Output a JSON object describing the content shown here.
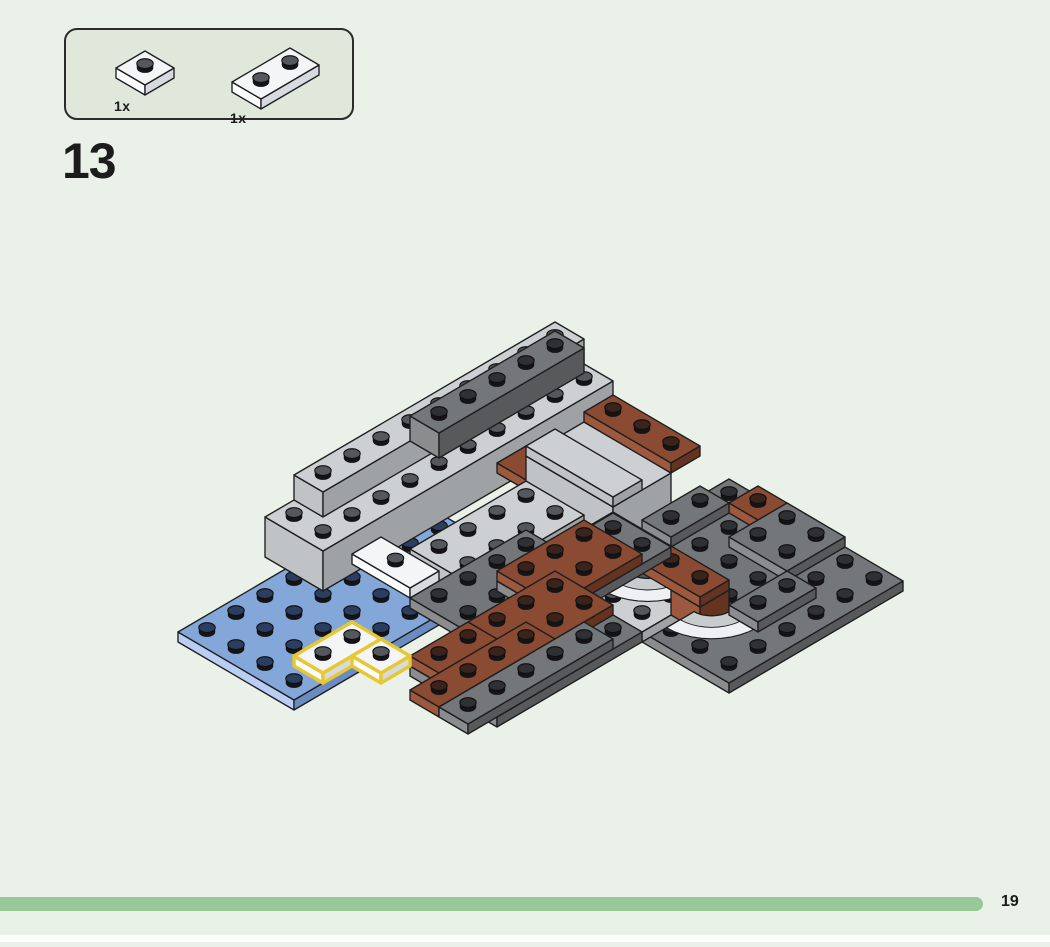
{
  "page": {
    "background": "#eaf1e8",
    "step_number": "13",
    "page_number": "19",
    "progress_color": "#97c998"
  },
  "parts_box": {
    "fill": "#dfe8db",
    "border_color": "#2b2c2b",
    "parts": [
      {
        "name": "white-plate-1x1",
        "qty_label": "1x",
        "piece": {
          "t": "box",
          "c": "WH",
          "x": 0,
          "y": 0,
          "w": 1,
          "d": 1,
          "z": 0,
          "h": 1,
          "studs": true
        }
      },
      {
        "name": "white-plate-1x2",
        "qty_label": "1x",
        "piece": {
          "t": "box",
          "c": "WH",
          "x": 0,
          "y": 0,
          "w": 2,
          "d": 1,
          "z": 0,
          "h": 1,
          "studs": true
        }
      }
    ]
  },
  "build": {
    "origin": [
      178,
      642
    ],
    "stud_dx": 29,
    "stud_dy": 17,
    "z_px": 10,
    "outline": "#1e1e20",
    "highlight": "#e7c832",
    "palette": {
      "BL": {
        "top": "#84a7da",
        "sw": "#b9cef2",
        "se": "#6a8cc0",
        "stud": "#2c3e5f"
      },
      "LG": {
        "top": "#cdd0d2",
        "sw": "#c0c3c5",
        "se": "#9fa2a4",
        "stud": "#54575b"
      },
      "DG": {
        "top": "#747779",
        "sw": "#8a8c8e",
        "se": "#58595b",
        "stud": "#2f3033"
      },
      "BR": {
        "top": "#8b4a32",
        "sw": "#9d593d",
        "se": "#643420",
        "stud": "#3a231a"
      },
      "WH": {
        "top": "#f3f5f7",
        "sw": "#fcfdfe",
        "se": "#d7dbdf",
        "stud": "#54585e"
      }
    },
    "arc_colors": {
      "main": "#c9ccce",
      "band": "#eef0f1"
    },
    "pieces": [
      {
        "t": "box",
        "c": "BL",
        "x": 0,
        "y": 0,
        "w": 8,
        "d": 4,
        "z": 0,
        "h": 1,
        "studs": true
      },
      {
        "t": "box",
        "c": "LG",
        "x": 4,
        "y": -1,
        "w": 10,
        "d": 2,
        "z": 0,
        "h": 4,
        "studs": true
      },
      {
        "t": "box",
        "c": "LG",
        "x": 5,
        "y": -1,
        "w": 9,
        "d": 1,
        "z": 4,
        "h": 2.5,
        "studs": true
      },
      {
        "t": "box",
        "c": "DG",
        "x": 8,
        "y": 0,
        "w": 5,
        "d": 1,
        "z": 6.5,
        "h": 2.5,
        "studs": true
      },
      {
        "t": "box",
        "c": "BR",
        "x": 9,
        "y": 2,
        "w": 1,
        "d": 3,
        "z": 5,
        "h": 1,
        "studs": false
      },
      {
        "t": "box",
        "c": "LG",
        "x": 10,
        "y": 2,
        "w": 2,
        "d": 3,
        "z": 0,
        "h": 5,
        "studs": false
      },
      {
        "t": "box",
        "c": "LG",
        "x": 10,
        "y": 2,
        "w": 1,
        "d": 3,
        "z": 5,
        "h": 1,
        "studs": false
      },
      {
        "t": "box",
        "c": "BR",
        "x": 12,
        "y": 2,
        "w": 1,
        "d": 3,
        "z": 5,
        "h": 1,
        "studs": true
      },
      {
        "t": "box",
        "c": "DG",
        "x": 8,
        "y": 5,
        "w": 6,
        "d": 6,
        "z": 0,
        "h": 1,
        "studs": true
      },
      {
        "t": "box",
        "c": "LG",
        "x": 8,
        "y": 6,
        "w": 2,
        "d": 2,
        "z": 0,
        "h": 1,
        "studs": true
      },
      {
        "t": "box",
        "c": "BR",
        "x": 13,
        "y": 6,
        "w": 1,
        "d": 2,
        "z": 1,
        "h": 1,
        "studs": true
      },
      {
        "t": "box",
        "c": "DG",
        "x": 11,
        "y": 5,
        "w": 2,
        "d": 1,
        "z": 1,
        "h": 1,
        "studs": true
      },
      {
        "t": "box",
        "c": "DG",
        "x": 12,
        "y": 7,
        "w": 2,
        "d": 2,
        "z": 1,
        "h": 1,
        "studs": true
      },
      {
        "t": "box",
        "c": "BR",
        "x": 9,
        "y": 5,
        "w": 1,
        "d": 1,
        "z": 1,
        "h": 2.5,
        "studs": false
      },
      {
        "t": "arc",
        "cx": 10.1,
        "cy": 6.1,
        "r": 1.55,
        "z": 1
      },
      {
        "t": "box",
        "c": "BR",
        "x": 9,
        "y": 8,
        "w": 1,
        "d": 1,
        "z": 1,
        "h": 2.5,
        "studs": false
      },
      {
        "t": "arc",
        "cx": 10.1,
        "cy": 8.3,
        "r": 1.55,
        "z": 1
      },
      {
        "t": "box",
        "c": "DG",
        "x": 10,
        "y": 9,
        "w": 2,
        "d": 1,
        "z": 1,
        "h": 1,
        "studs": true
      },
      {
        "t": "box",
        "c": "BR",
        "x": 9,
        "y": 5,
        "w": 1,
        "d": 4,
        "z": 3.5,
        "h": 1,
        "studs": true
      },
      {
        "t": "box",
        "c": "LG",
        "x": 6,
        "y": 2,
        "w": 4,
        "d": 2,
        "z": 0,
        "h": 2.5,
        "studs": true
      },
      {
        "t": "box",
        "c": "DG",
        "x": 5,
        "y": 3,
        "w": 4,
        "d": 2,
        "z": 0,
        "h": 1,
        "studs": true
      },
      {
        "t": "box",
        "c": "DG",
        "x": 3,
        "y": 5,
        "w": 5,
        "d": 3,
        "z": 0,
        "h": 1,
        "studs": true
      },
      {
        "t": "box",
        "c": "DG",
        "x": 7,
        "y": 4,
        "w": 4,
        "d": 2,
        "z": 0,
        "h": 1,
        "studs": true
      },
      {
        "t": "box",
        "c": "BR",
        "x": 7,
        "y": 4,
        "w": 3,
        "d": 2,
        "z": 1,
        "h": 1,
        "studs": true
      },
      {
        "t": "box",
        "c": "BR",
        "x": 5,
        "y": 5,
        "w": 3,
        "d": 2,
        "z": 1,
        "h": 1,
        "studs": true
      },
      {
        "t": "box",
        "c": "BR",
        "x": 3,
        "y": 5,
        "w": 2,
        "d": 1,
        "z": 1,
        "h": 1,
        "studs": true
      },
      {
        "t": "box",
        "c": "BR",
        "x": 2,
        "y": 6,
        "w": 4,
        "d": 1,
        "z": 1,
        "h": 1,
        "studs": true
      },
      {
        "t": "box",
        "c": "DG",
        "x": 2,
        "y": 7,
        "w": 5,
        "d": 1,
        "z": 1,
        "h": 1,
        "studs": true
      },
      {
        "t": "box",
        "c": "WH",
        "x": 5,
        "y": 1,
        "w": 1,
        "d": 2,
        "z": 1,
        "h": 1,
        "studs": "center"
      },
      {
        "t": "box",
        "c": "WH",
        "x": 1,
        "y": 3,
        "w": 2,
        "d": 1,
        "z": 1,
        "h": 1,
        "studs": true,
        "hl": true
      },
      {
        "t": "box",
        "c": "WH",
        "x": 2,
        "y": 4,
        "w": 1,
        "d": 1,
        "z": 1,
        "h": 1,
        "studs": true,
        "hl": true
      }
    ]
  }
}
